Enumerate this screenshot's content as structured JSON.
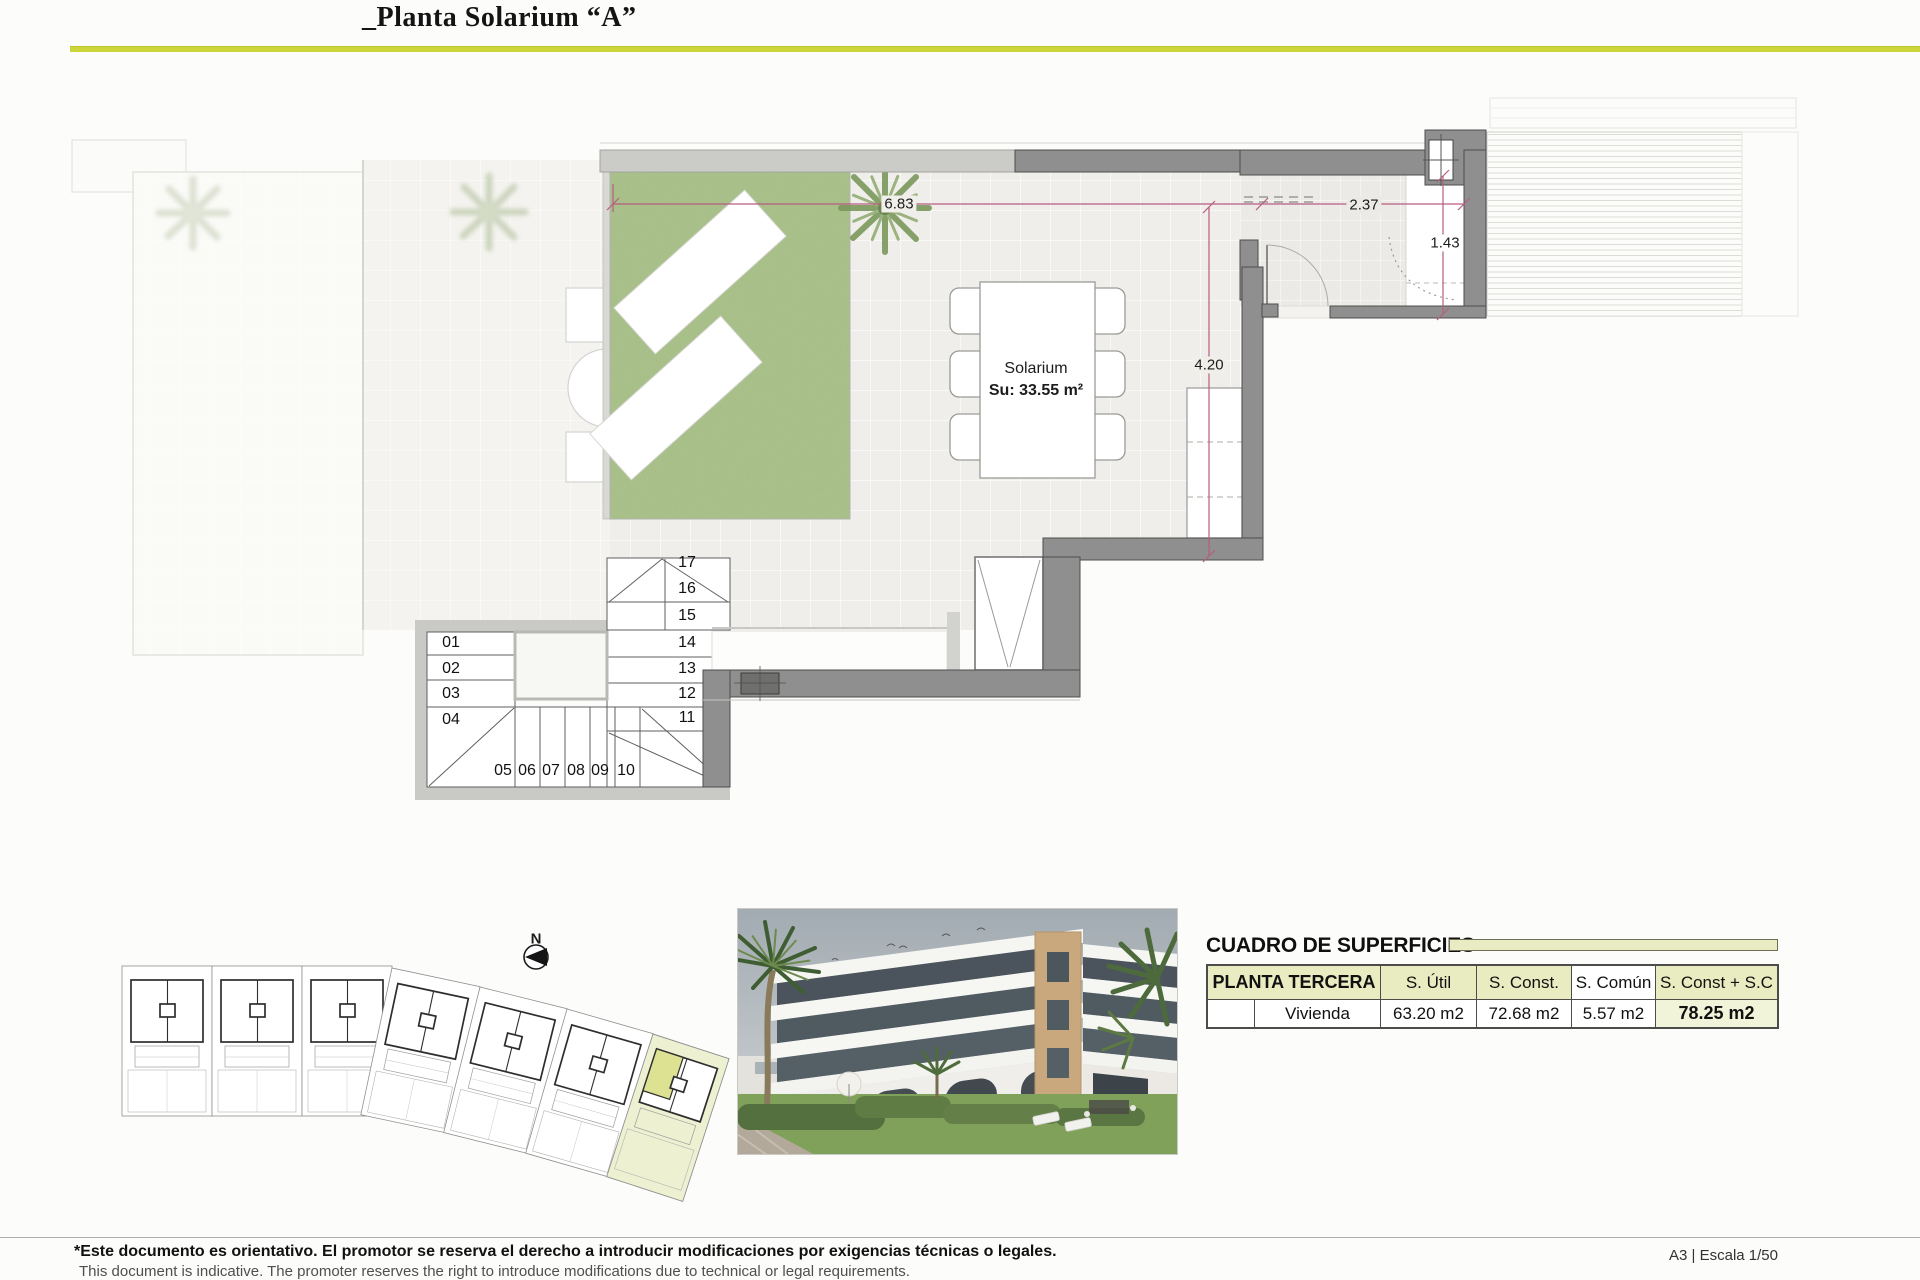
{
  "page": {
    "title": "_Planta Solarium “A”",
    "accent_color": "#ccd63b"
  },
  "plan": {
    "labels": {
      "room": "Solarium",
      "area": "Su: 33.55 m²"
    },
    "dimensions": {
      "garden_width": "6.83",
      "room_width": "2.37",
      "room_depth": "1.43",
      "terrace_depth": "4.20"
    },
    "stair_steps": [
      "01",
      "02",
      "03",
      "04",
      "05",
      "06",
      "07",
      "08",
      "09",
      "10",
      "11",
      "12",
      "13",
      "14",
      "15",
      "16",
      "17"
    ],
    "compass_n": "N",
    "dimension_line_color": "#b85c80",
    "garden_color": "#abc28d"
  },
  "surfaces": {
    "section_title": "CUADRO DE SUPERFICIES",
    "floor_label": "PLANTA TERCERA",
    "col_util": "S. Útil",
    "col_const": "S. Const.",
    "col_comun": "S. Común",
    "col_total": "S. Const + S.C",
    "row_label": "Vivienda",
    "val_util": "63.20 m2",
    "val_const": "72.68 m2",
    "val_comun": "5.57 m2",
    "val_total": "78.25 m2",
    "header_bg": "#e9ecc0",
    "highlight_lot_color": "#eef0d2"
  },
  "footer": {
    "disclaimer_es": "*Este documento es orientativo. El promotor se reserva el derecho a introducir modificaciones por exigencias técnicas o legales.",
    "disclaimer_en": "This document is indicative. The promoter reserves the right to introduce modifications due to technical or legal requirements.",
    "sheet_info": "A3 | Escala 1/50"
  }
}
